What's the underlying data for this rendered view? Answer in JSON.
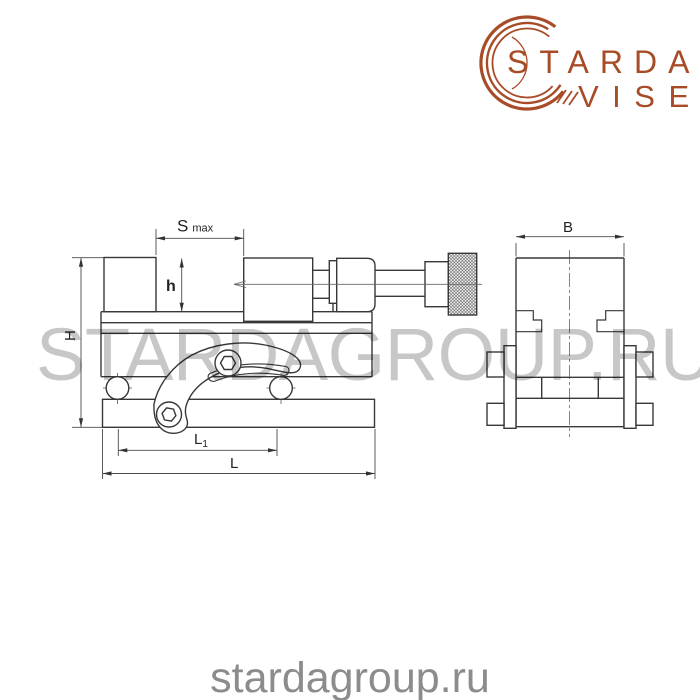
{
  "logo": {
    "line1": "STARDA",
    "line2": "VISE",
    "accent_color": "#a84c28"
  },
  "watermark": {
    "text": "STARDAGROUP.RU",
    "color": "#c7c7c7"
  },
  "footer": {
    "text": "stardagroup.ru",
    "color": "#8c8c8c"
  },
  "drawing": {
    "line_color": "#383838",
    "dim_color": "#4a4a4a",
    "views": {
      "front": "side elevation of precision vise",
      "end": "end elevation of precision vise"
    },
    "dimensions": {
      "smax_main": "S",
      "smax_sub": "max",
      "h": "h",
      "H": "H",
      "l1_main": "L",
      "l1_sub": "1",
      "l": "L",
      "b": "B"
    }
  }
}
